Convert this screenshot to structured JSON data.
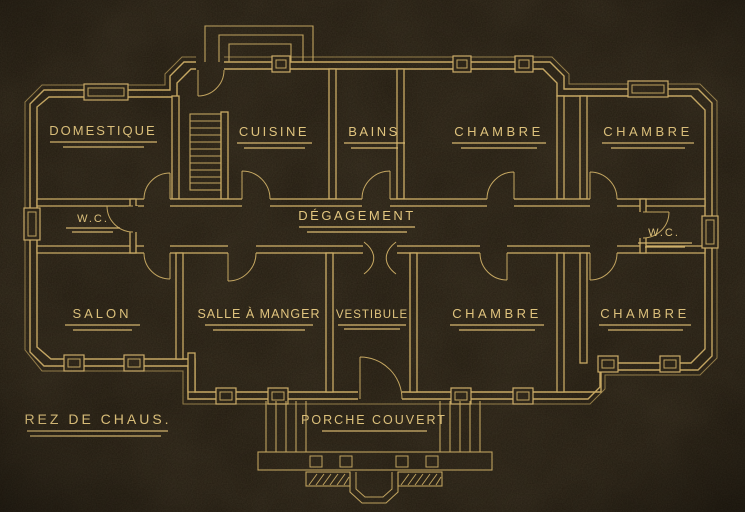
{
  "scene": {
    "description": "Vintage architectural drawing: ground-floor plan of a house, gold lines on black paper",
    "background_color": "#20190e",
    "line_color": "#cfae63",
    "text_color": "#e6c87d"
  },
  "plan": {
    "floor_label": "REZ DE CHAUS.",
    "corridor_label": "DÉGAGEMENT",
    "porch_label": "PORCHE COUVERT",
    "rooms": {
      "domestique": "DOMESTIQUE",
      "cuisine": "CUISINE",
      "bains": "BAINS",
      "chambre_top_center": "CHAMBRE",
      "chambre_top_right": "CHAMBRE",
      "wc_west": "W.C.",
      "wc_east": "W.C.",
      "salon": "SALON",
      "salle_a_manger": "SALLE À MANGER",
      "vestibule": "VESTIBULE",
      "chambre_bottom_center": "CHAMBRE",
      "chambre_bottom_right": "CHAMBRE"
    }
  }
}
